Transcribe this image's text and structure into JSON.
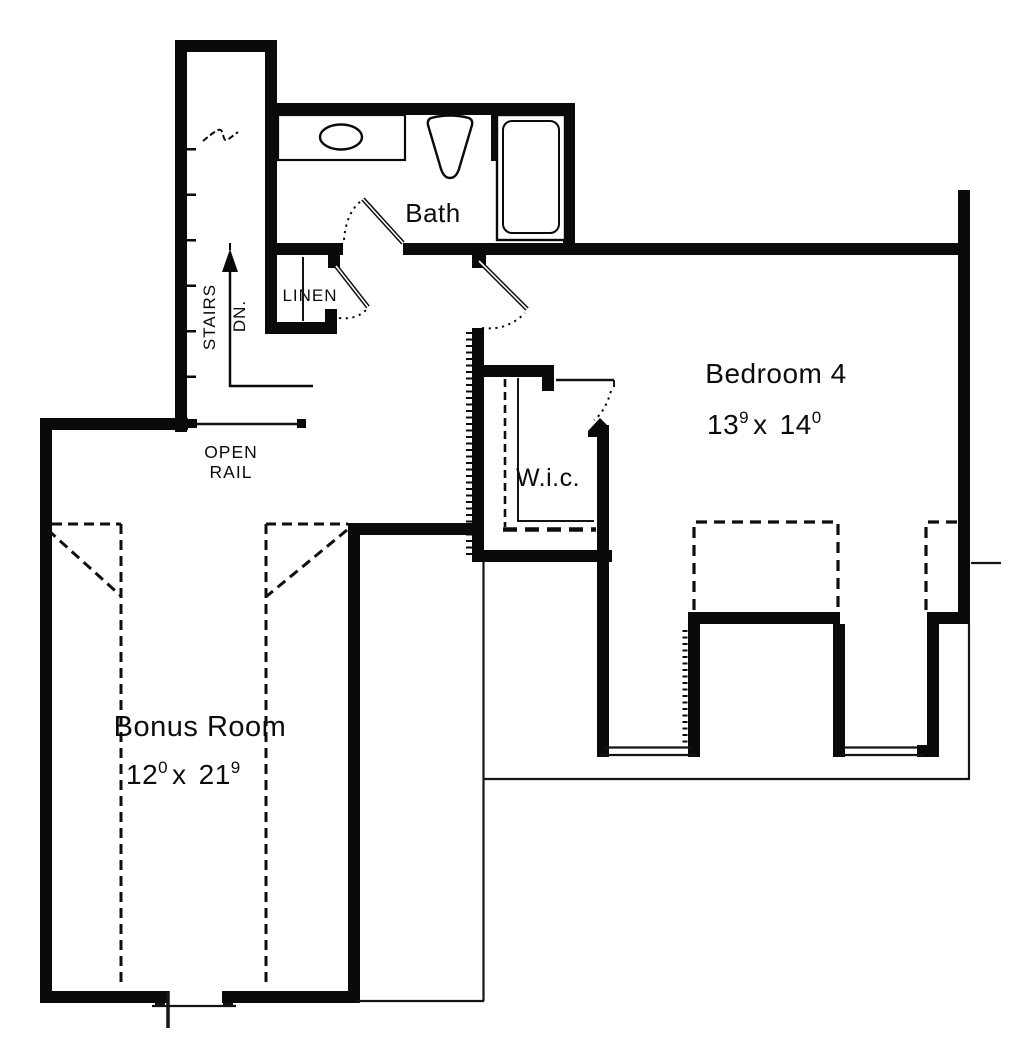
{
  "rooms": {
    "bath": {
      "label": "Bath"
    },
    "bedroom4": {
      "label": "Bedroom 4",
      "dim": {
        "a": "13",
        "a_sup": "9",
        "sep": "x",
        "b": "14",
        "b_sup": "0"
      }
    },
    "wic": {
      "label": "W.i.c."
    },
    "bonus_room": {
      "label": "Bonus Room",
      "dim": {
        "a": "12",
        "a_sup": "0",
        "sep": "x",
        "b": "21",
        "b_sup": "9"
      }
    },
    "linen": {
      "label": "LINEN"
    },
    "stairs": {
      "label": "STAIRS",
      "direction": "DN."
    },
    "open_rail": {
      "line1": "OPEN",
      "line2": "RAIL"
    }
  },
  "fixtures": [
    {
      "name": "vanity-counter"
    },
    {
      "name": "oval-sink"
    },
    {
      "name": "toilet"
    },
    {
      "name": "bathtub"
    }
  ],
  "colors": {
    "wall": "#0a0a0a",
    "line": "#141414",
    "background": "#ffffff"
  }
}
